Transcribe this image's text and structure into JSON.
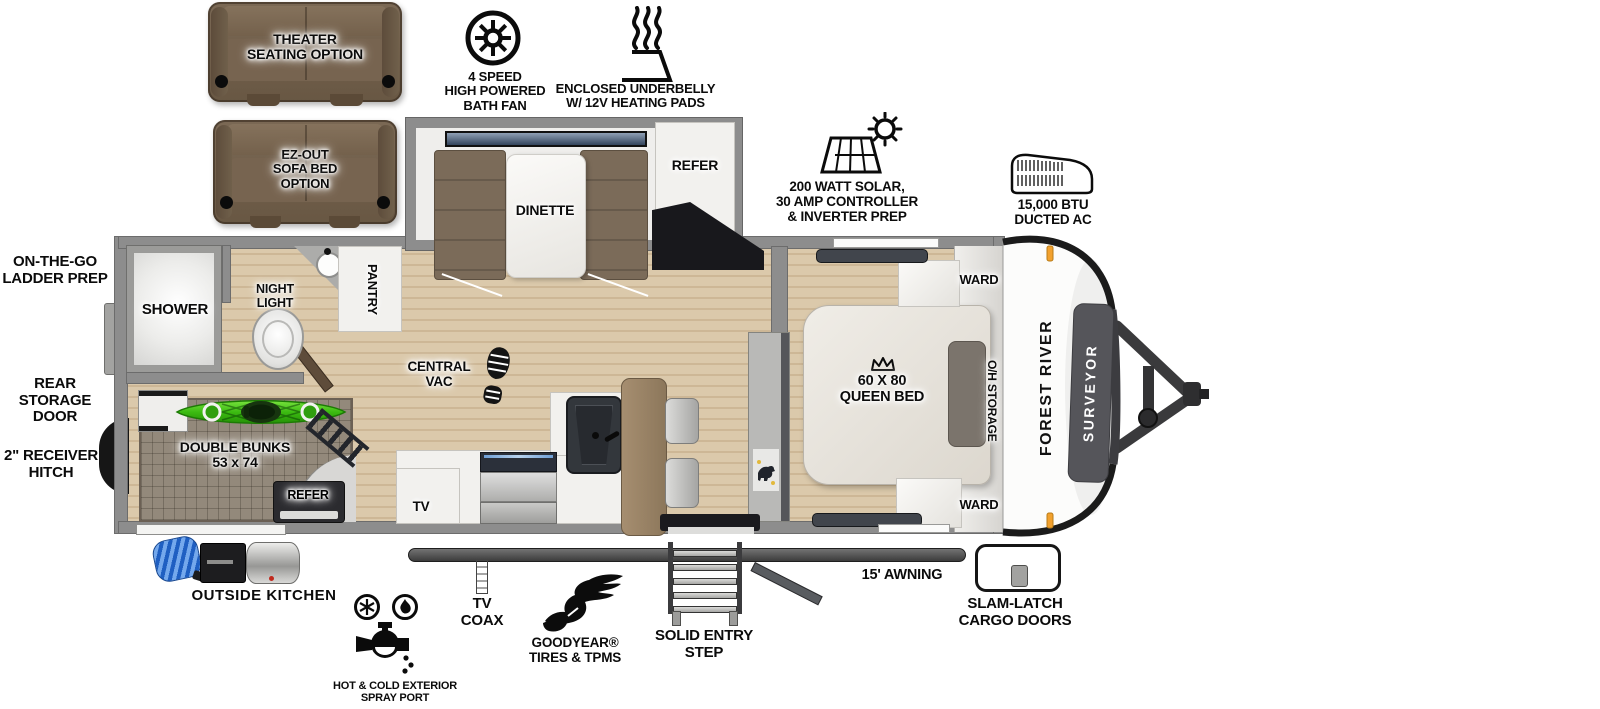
{
  "title": "Forest River Surveyor travel trailer floor plan",
  "options": {
    "theater": "THEATER\nSEATING OPTION",
    "sofa_bed": "EZ-OUT\nSOFA BED\nOPTION"
  },
  "features": {
    "bath_fan": "4 SPEED\nHIGH POWERED\nBATH FAN",
    "underbelly": "ENCLOSED UNDERBELLY\nW/ 12V HEATING PADS",
    "solar": "200 WATT SOLAR,\n30 AMP CONTROLLER\n& INVERTER PREP",
    "ac": "15,000 BTU\nDUCTED AC"
  },
  "interior": {
    "dinette": "DINETTE",
    "refer": "REFER",
    "pantry": "PANTRY",
    "shower": "SHOWER",
    "night_light": "NIGHT\nLIGHT",
    "central_vac": "CENTRAL\nVAC",
    "tv": "TV",
    "double_bunks": "DOUBLE BUNKS\n53 x 74",
    "bunk_refer": "REFER",
    "queen_bed": "60 X 80\nQUEEN BED",
    "ward_top": "WARD",
    "ward_bottom": "WARD",
    "oh_storage": "O/H STORAGE"
  },
  "exterior": {
    "ladder_prep": "ON-THE-GO\nLADDER PREP",
    "rear_storage_door": "REAR STORAGE\nDOOR",
    "receiver_hitch": "2\" RECEIVER\nHITCH",
    "outside_kitchen": "OUTSIDE KITCHEN",
    "spray_port": "HOT & COLD EXTERIOR\nSPRAY PORT",
    "tv_coax": "TV\nCOAX",
    "tires": "GOODYEAR®\nTIRES & TPMS",
    "entry_step": "SOLID ENTRY\nSTEP",
    "awning": "15' AWNING",
    "cargo_doors": "SLAM-LATCH\nCARGO DOORS"
  },
  "branding": {
    "manufacturer": "FOREST RIVER",
    "model": "SURVEYOR"
  },
  "colors": {
    "floor_wood": "#d9c6a8",
    "wall_gray": "#8d8d8d",
    "kayak_green": "#3cbb12",
    "sofa_brown": "#6e5c49",
    "marker_orange": "#f2a12e",
    "counter_black": "#18181c"
  }
}
